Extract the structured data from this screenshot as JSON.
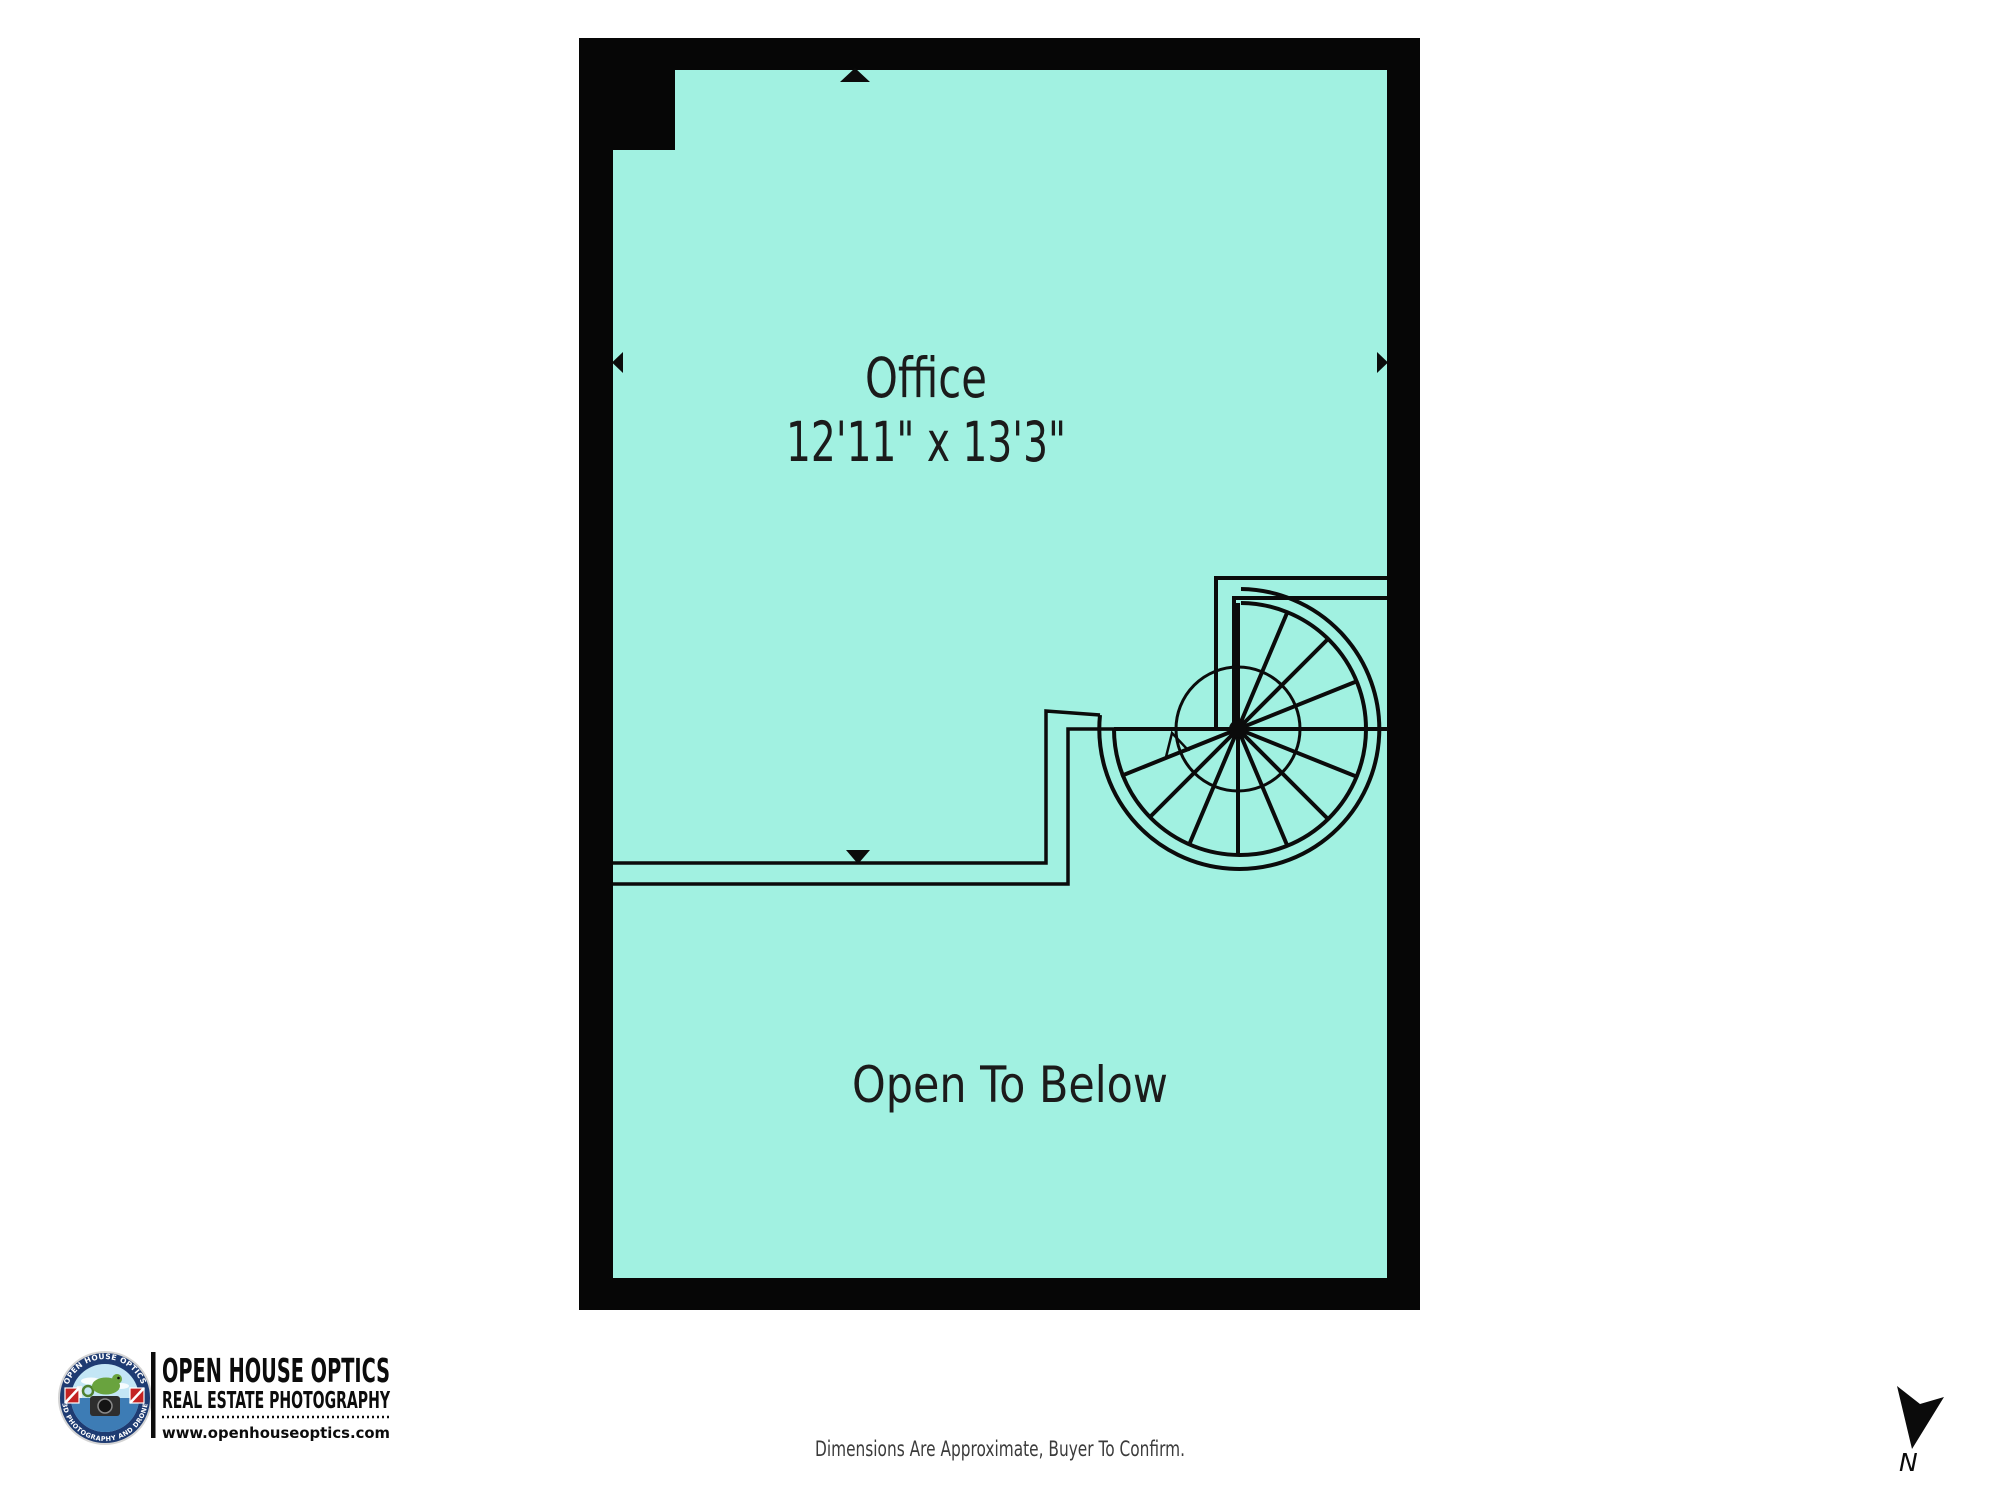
{
  "page": {
    "background_color": "#ffffff"
  },
  "floor_plan": {
    "fill_color": "#A1F1E1",
    "wall_color": "#060606",
    "line_color": "#0b0b0b",
    "rooms": [
      {
        "name": "Office",
        "dimensions": "12'11\" x 13'3\""
      },
      {
        "name": "Open To Below",
        "dimensions": ""
      }
    ]
  },
  "branding": {
    "badge_arc_top": "OPEN HOUSE OPTICS",
    "badge_arc_bottom": "3D PHOTOGRAPHY AND DRONE",
    "company_name": "OPEN HOUSE OPTICS",
    "tagline": "REAL ESTATE PHOTOGRAPHY",
    "website": "www.openhouseoptics.com"
  },
  "footer": {
    "disclaimer": "Dimensions Are Approximate, Buyer To Confirm."
  },
  "compass": {
    "label": "N"
  }
}
